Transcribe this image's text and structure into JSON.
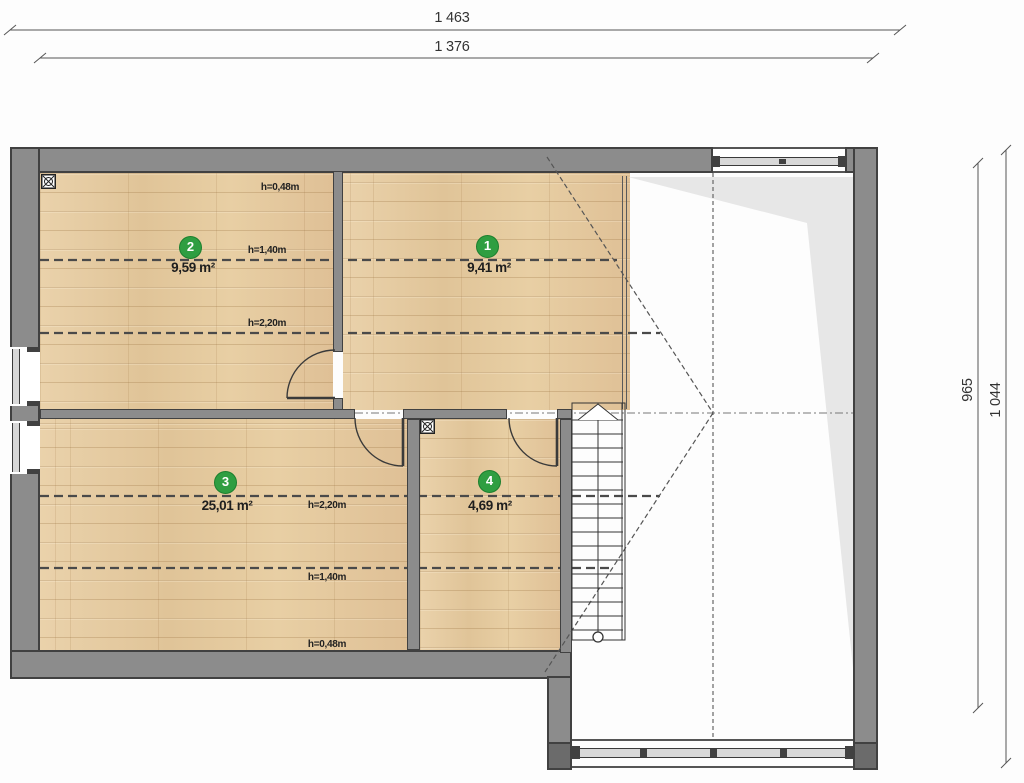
{
  "drawing": {
    "type": "attic floor plan",
    "dimensions": {
      "top": [
        "1 463",
        "1 376"
      ],
      "right": [
        "965",
        "1 044"
      ]
    },
    "rooms": [
      {
        "number": "1",
        "area": "9,41 m²"
      },
      {
        "number": "2",
        "area": "9,59 m²"
      },
      {
        "number": "3",
        "area": "25,01 m²"
      },
      {
        "number": "4",
        "area": "4,69 m²"
      }
    ],
    "height_lines": {
      "upper": [
        "h=0,48m",
        "h=1,40m",
        "h=2,20m"
      ],
      "lower": [
        "h=2,20m",
        "h=1,40m",
        "h=0,48m"
      ]
    },
    "colors": {
      "room_badge_green": "#2f9e41",
      "wall_fill": "#8c8c8c",
      "wall_edge": "#414141",
      "wood_floor": "#e6cda6",
      "roof_shade": "#e7e7e7"
    }
  }
}
